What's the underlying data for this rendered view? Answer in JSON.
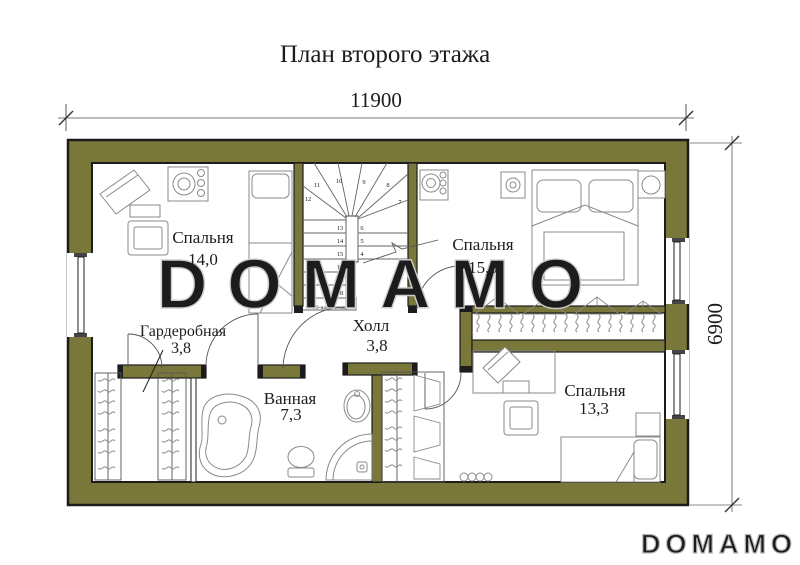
{
  "title": "План второго этажа",
  "dimensions": {
    "width": "11900",
    "height": "6900"
  },
  "rooms": [
    {
      "id": "bedroom-1",
      "name": "Спальня",
      "area": "14,0"
    },
    {
      "id": "bedroom-2",
      "name": "Спальня",
      "area": "15,0"
    },
    {
      "id": "wardrobe",
      "name": "Гардеробная",
      "area": "3,8"
    },
    {
      "id": "hall",
      "name": "Холл",
      "area": "3,8"
    },
    {
      "id": "bathroom",
      "name": "Ванная",
      "area": "7,3"
    },
    {
      "id": "bedroom-3",
      "name": "Спальня",
      "area": "13,3"
    }
  ],
  "stairs": {
    "steps": [
      "4",
      "5",
      "6",
      "7",
      "8",
      "9",
      "10",
      "11",
      "12",
      "13",
      "14",
      "15",
      "16",
      "17",
      "18"
    ],
    "note": "19-ная 2-этаж."
  },
  "watermark": "DOMAMO",
  "footer_logo": "DOMAMO",
  "colors": {
    "wall": "#7a773b",
    "outline": "#1c1c1c",
    "furniture": "#8a8a8a",
    "dimension": "#444444",
    "watermark_outline": "#cccccc"
  }
}
